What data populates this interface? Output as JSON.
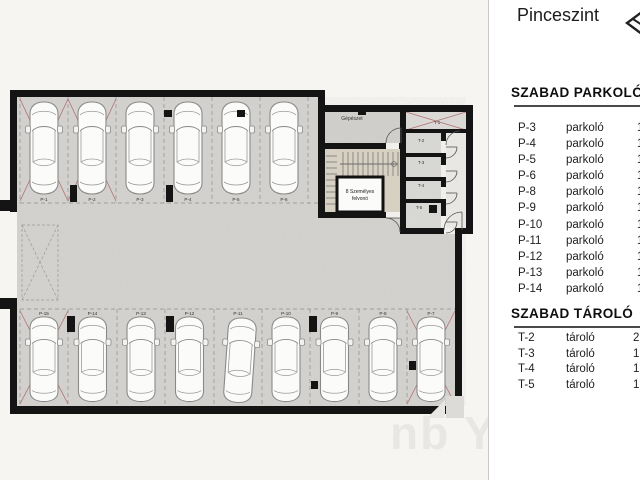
{
  "sidebar": {
    "title": "Pinceszint",
    "north_icon": "north-arrow (clipped at edge)",
    "parking": {
      "heading": "SZABAD PARKOLÓ",
      "rows": [
        {
          "id": "P-3",
          "type": "parkoló",
          "more": "1"
        },
        {
          "id": "P-4",
          "type": "parkoló",
          "more": "1"
        },
        {
          "id": "P-5",
          "type": "parkoló",
          "more": "1"
        },
        {
          "id": "P-6",
          "type": "parkoló",
          "more": "1"
        },
        {
          "id": "P-8",
          "type": "parkoló",
          "more": "1"
        },
        {
          "id": "P-9",
          "type": "parkoló",
          "more": "1"
        },
        {
          "id": "P-10",
          "type": "parkoló",
          "more": "1"
        },
        {
          "id": "P-11",
          "type": "parkoló",
          "more": "1"
        },
        {
          "id": "P-12",
          "type": "parkoló",
          "more": "1"
        },
        {
          "id": "P-13",
          "type": "parkoló",
          "more": "1"
        },
        {
          "id": "P-14",
          "type": "parkoló",
          "more": "1"
        }
      ]
    },
    "storage": {
      "heading": "SZABAD TÁROLÓ",
      "rows": [
        {
          "id": "T-2",
          "type": "tároló",
          "more": "2"
        },
        {
          "id": "T-3",
          "type": "tároló",
          "more": "1"
        },
        {
          "id": "T-4",
          "type": "tároló",
          "more": "1"
        },
        {
          "id": "T-5",
          "type": "tároló",
          "more": "1"
        }
      ]
    }
  },
  "plan": {
    "labels": {
      "mechanical_room": "Gépészet",
      "elevator_line1": "8 Személyes",
      "elevator_line2": "felvonó"
    },
    "top_stalls": [
      {
        "id": "P-1",
        "sold": true
      },
      {
        "id": "P-2",
        "sold": true
      },
      {
        "id": "P-3",
        "sold": false
      },
      {
        "id": "P-4",
        "sold": false
      },
      {
        "id": "P-5",
        "sold": false
      },
      {
        "id": "P-6",
        "sold": false
      }
    ],
    "bottom_stalls": [
      {
        "id": "P-15",
        "sold": true
      },
      {
        "id": "P-14",
        "sold": false
      },
      {
        "id": "P-13",
        "sold": false
      },
      {
        "id": "P-12",
        "sold": false
      },
      {
        "id": "P-11",
        "sold": false
      },
      {
        "id": "P-10",
        "sold": false
      },
      {
        "id": "P-9",
        "sold": false
      },
      {
        "id": "P-8",
        "sold": false
      },
      {
        "id": "P-7",
        "sold": true
      }
    ],
    "storage_units": [
      {
        "id": "T-1",
        "sold": true
      },
      {
        "id": "T-2",
        "sold": false
      },
      {
        "id": "T-3",
        "sold": false
      },
      {
        "id": "T-4",
        "sold": false
      },
      {
        "id": "T-5",
        "sold": false
      }
    ]
  },
  "colors": {
    "margin_bg": "#f7f5f2",
    "sidebar_bg": "#ffffff",
    "wall": "#141414",
    "concrete_floor": "#d5d3d0",
    "stair_floor": "#d9d3c3",
    "corridor_floor": "#edebe7",
    "sold_x": "#b07272",
    "stall_line": "#8f8f8f",
    "text": "#1e1e1e"
  }
}
